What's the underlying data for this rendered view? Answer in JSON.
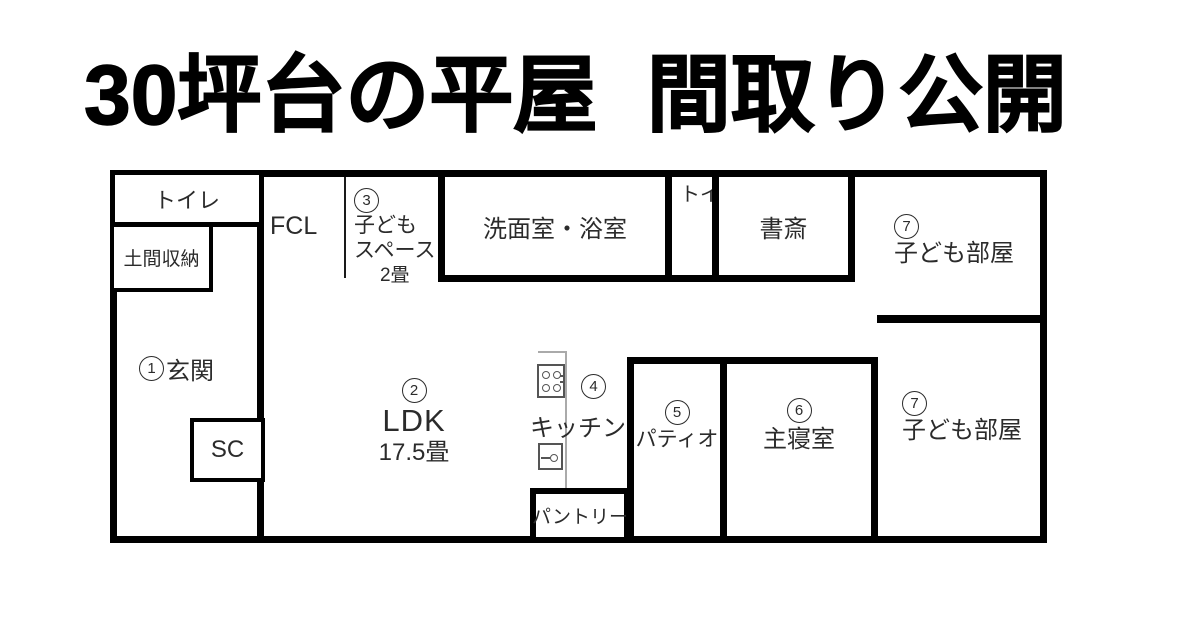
{
  "title": "30坪台の平屋 間取り公開",
  "floorplan": {
    "rooms": {
      "toilet1": {
        "label": "トイレ"
      },
      "doma": {
        "label": "土間収納"
      },
      "genkan": {
        "num": "1",
        "label": "玄関"
      },
      "sc": {
        "label": "SC"
      },
      "fcl": {
        "label": "FCL"
      },
      "kids_space": {
        "num": "3",
        "line1": "子ども",
        "line2": "スペース",
        "size": "2畳"
      },
      "senmen": {
        "label": "洗面室・浴室"
      },
      "toilet2": {
        "label": "トイレ"
      },
      "shosai": {
        "label": "書斎"
      },
      "kids_room_upper": {
        "num": "7",
        "label": "子ども部屋"
      },
      "ldk": {
        "num": "2",
        "label": "LDK",
        "size": "17.5畳"
      },
      "kitchen": {
        "num": "4",
        "label": "キッチン"
      },
      "pantry": {
        "label": "パントリー"
      },
      "patio": {
        "num": "5",
        "label": "パティオ"
      },
      "master": {
        "num": "6",
        "label": "主寝室"
      },
      "kids_room_lower": {
        "num": "7",
        "label": "子ども部屋"
      }
    }
  },
  "colors": {
    "wall": "#000000",
    "text": "#2b2b2b",
    "counter": "#aaaaaa",
    "background": "#ffffff"
  }
}
